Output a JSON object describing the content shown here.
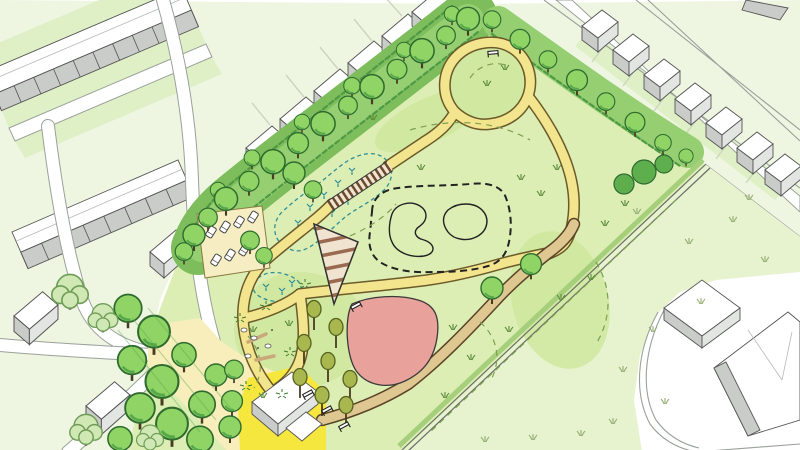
{
  "scene": {
    "label": "Hand-drawn aerial masterplan illustration of a neighbourhood park surrounded by housing",
    "view": "isometric sketch plan"
  },
  "colors": {
    "paper": "#ffffff",
    "parkGrass": "#ddeeb5",
    "meadowPale": "#e7f3cf",
    "blockPale": "#eef6e2",
    "gardenDeep": "#dff0c6",
    "moundGreen": "#cfe79c",
    "beltGreen": "#7dbd5c",
    "beltGreenLight": "#95cf72",
    "beltDark": "#4f9a44",
    "hedgeGreen": "#a6cf7c",
    "shrubGreen": "#5fae4e",
    "treeGreen": "#8fd464",
    "treeDark": "#2f6b2f",
    "treeShadow": "#57a84c",
    "treePale": "#cfe8b4",
    "treePaleStroke": "#6f9d58",
    "treeOlive": "#a9b84e",
    "pathYellow": "#f3e48e",
    "pathCasing": "#6b5a2a",
    "pathTan": "#dfc791",
    "tanCasing": "#5a4326",
    "roadWhite": "#ffffff",
    "roadStroke": "#9aa09a",
    "junctionTint": "#f8eebb",
    "plazaYellow": "#f6e73e",
    "parkingCream": "#f6eec2",
    "pondBlue": "#c6ebf0",
    "pondStroke": "#2e8f96",
    "pumpTrackPurple": "#a9a2cf",
    "playPink": "#e9a29b",
    "deckCream": "#f0e4d0",
    "deckStripe": "#9a6a50",
    "roofWhite": "#ffffff",
    "wallGrey": "#c9ccc9",
    "wallGreyLight": "#e2e5e2",
    "outlineDark": "#3a3a3a",
    "inkDark": "#222222",
    "grassTuft": "#5a8a3a",
    "lawnTuft": "#94ad72",
    "contourDash": "#7fa050"
  },
  "features": {
    "park_area": "public park with looping footpaths",
    "tree_belt": "dense tree belt along north-west and north-east boundaries",
    "pond": "wetland pond with marsh planting",
    "boardwalk": "timber boardwalk crossing the pond",
    "deck": "triangular striped timber deck beside the pond",
    "pump_track": "purple pump-track loop with dashed edge",
    "play_area": "pink play / sand area",
    "nature_play": "natural play glade with logs, boulders and planting",
    "orchard": "orchard trees with picnic benches",
    "parking": "small parking court with parked cars",
    "plaza": "bright yellow entrance plaza with pavilion building",
    "meadow": "open meadow with dashed mown edges and grass tufts",
    "terraced_housing": "terraced housing rows to the north-west",
    "detached_housing": "detached housing row along the north-east street",
    "school_campus": "large white buildings with curved boundary wall to the south-east",
    "roads": "surrounding streets, junction tinted pale yellow"
  },
  "counts": {
    "cars_in_parking": 7,
    "picnic_benches": 4,
    "lookout_benches": 1
  }
}
